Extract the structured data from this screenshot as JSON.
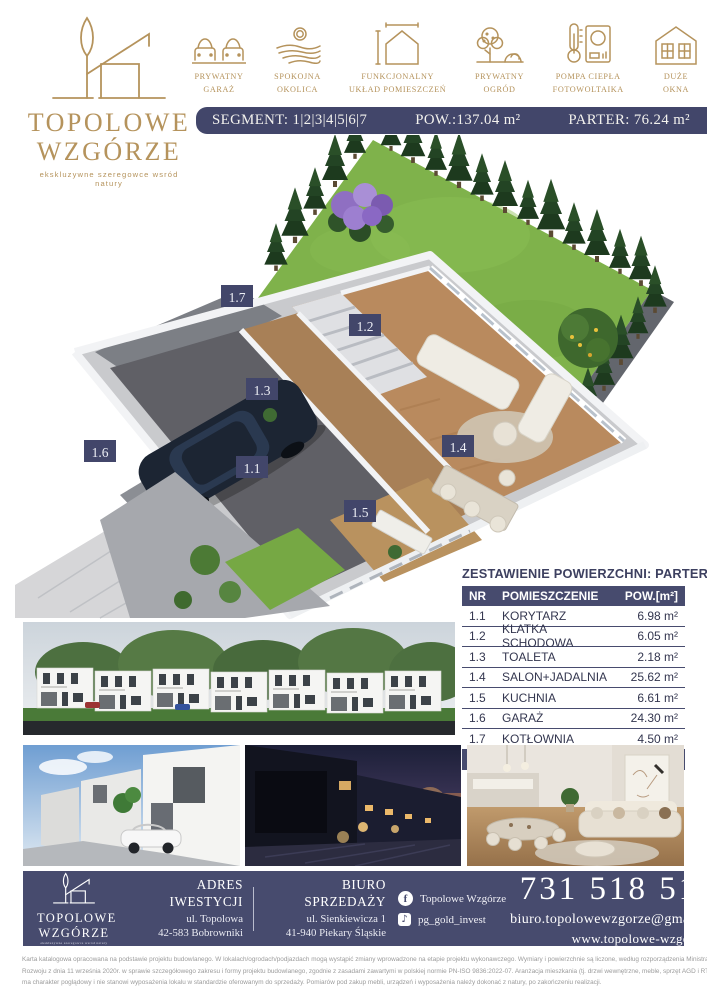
{
  "colors": {
    "navy": "#42466a",
    "navy_light": "#474b6e",
    "gold": "#b5935c"
  },
  "brand": {
    "line1": "TOPOLOWE",
    "line2": "WZGÓRZE",
    "tagline": "ekskluzywne szeregowce wsród natury"
  },
  "features": [
    {
      "icon": "private-garage-icon",
      "line1": "PRYWATNY",
      "line2": "GARAŻ"
    },
    {
      "icon": "quiet-area-icon",
      "line1": "SPOKOJNA",
      "line2": "OKOLICA"
    },
    {
      "icon": "functional-layout-icon",
      "line1": "FUNKCJONALNY",
      "line2": "UKŁAD POMIESZCZEŃ"
    },
    {
      "icon": "private-garden-icon",
      "line1": "PRYWATNY",
      "line2": "OGRÓD"
    },
    {
      "icon": "heat-pump-icon",
      "line1": "POMPA CIEPŁA",
      "line2": "FOTOWOLTAIKA"
    },
    {
      "icon": "big-windows-icon",
      "line1": "DUŻE",
      "line2": "OKNA"
    }
  ],
  "segment_bar": {
    "segment": "SEGMENT: 1|2|3|4|5|6|7",
    "total_area": "POW.:137.04 m²",
    "floor_area": "PARTER: 76.24 m²"
  },
  "floorplan": {
    "labels": [
      {
        "id": "1.1"
      },
      {
        "id": "1.2"
      },
      {
        "id": "1.3"
      },
      {
        "id": "1.4"
      },
      {
        "id": "1.5"
      },
      {
        "id": "1.6"
      },
      {
        "id": "1.7"
      }
    ]
  },
  "table": {
    "title": "ZESTAWIENIE POWIERZCHNI: PARTER",
    "headers": {
      "nr": "NR",
      "room": "POMIESZCZENIE",
      "area": "POW.[m²]"
    },
    "rows": [
      {
        "nr": "1.1",
        "room": "KORYTARZ",
        "area": "6.98 m²"
      },
      {
        "nr": "1.2",
        "room": "KLATKA SCHODOWA",
        "area": "6.05 m²"
      },
      {
        "nr": "1.3",
        "room": "TOALETA",
        "area": "2.18 m²"
      },
      {
        "nr": "1.4",
        "room": "SALON+JADALNIA",
        "area": "25.62 m²"
      },
      {
        "nr": "1.5",
        "room": "KUCHNIA",
        "area": "6.61 m²"
      },
      {
        "nr": "1.6",
        "room": "GARAŻ",
        "area": "24.30 m²"
      },
      {
        "nr": "1.7",
        "room": "KOTŁOWNIA",
        "area": "4.50 m²"
      }
    ],
    "total": {
      "label": "RAZEM",
      "area": "76.24 m²"
    }
  },
  "footer": {
    "address": {
      "heading": "ADRES IWESTYCJI",
      "line1": "ul. Topolowa",
      "line2": "42-583 Bobrowniki"
    },
    "sales": {
      "heading": "BIURO SPRZEDAŻY",
      "line1": "ul. Sienkiewicza 1",
      "line2": "41-940 Piekary Śląskie"
    },
    "social": [
      {
        "network": "facebook",
        "label": "Topolowe Wzgórze"
      },
      {
        "network": "tiktok",
        "label": "pg_gold_invest"
      }
    ],
    "phone": "731 518 516",
    "email": "biuro.topolowewzgorze@gmail.com",
    "website": "www.topolowe-wzgorze.pl"
  },
  "disclaimer": {
    "line1": "Karta katalogowa opracowana na podstawie projektu budowlanego. W lokalach/ogrodach/podjazdach mogą wystąpić zmiany wprowadzone na etapie projektu wykonawczego. Wymiary i powierzchnie są liczone, według rozporządzenia Ministra",
    "line2": "Rozwoju z dnia 11 września 2020r. w sprawie szczegółowego zakresu i formy projektu budowlanego, zgodnie z zasadami zawartymi w polskiej normie PN-ISO 9836:2022-07. Aranżacja mieszkania (tj. drzwi wewnętrzne, meble, sprzęt AGD i RTV)",
    "line3": "ma charakter poglądowy i nie stanowi wyposażenia lokalu w standardzie oferowanym do sprzedaży. Pomiarów pod zakup mebli, urządzeń i wyposażenia należy dokonać z natury, po zakończeniu realizacji."
  }
}
